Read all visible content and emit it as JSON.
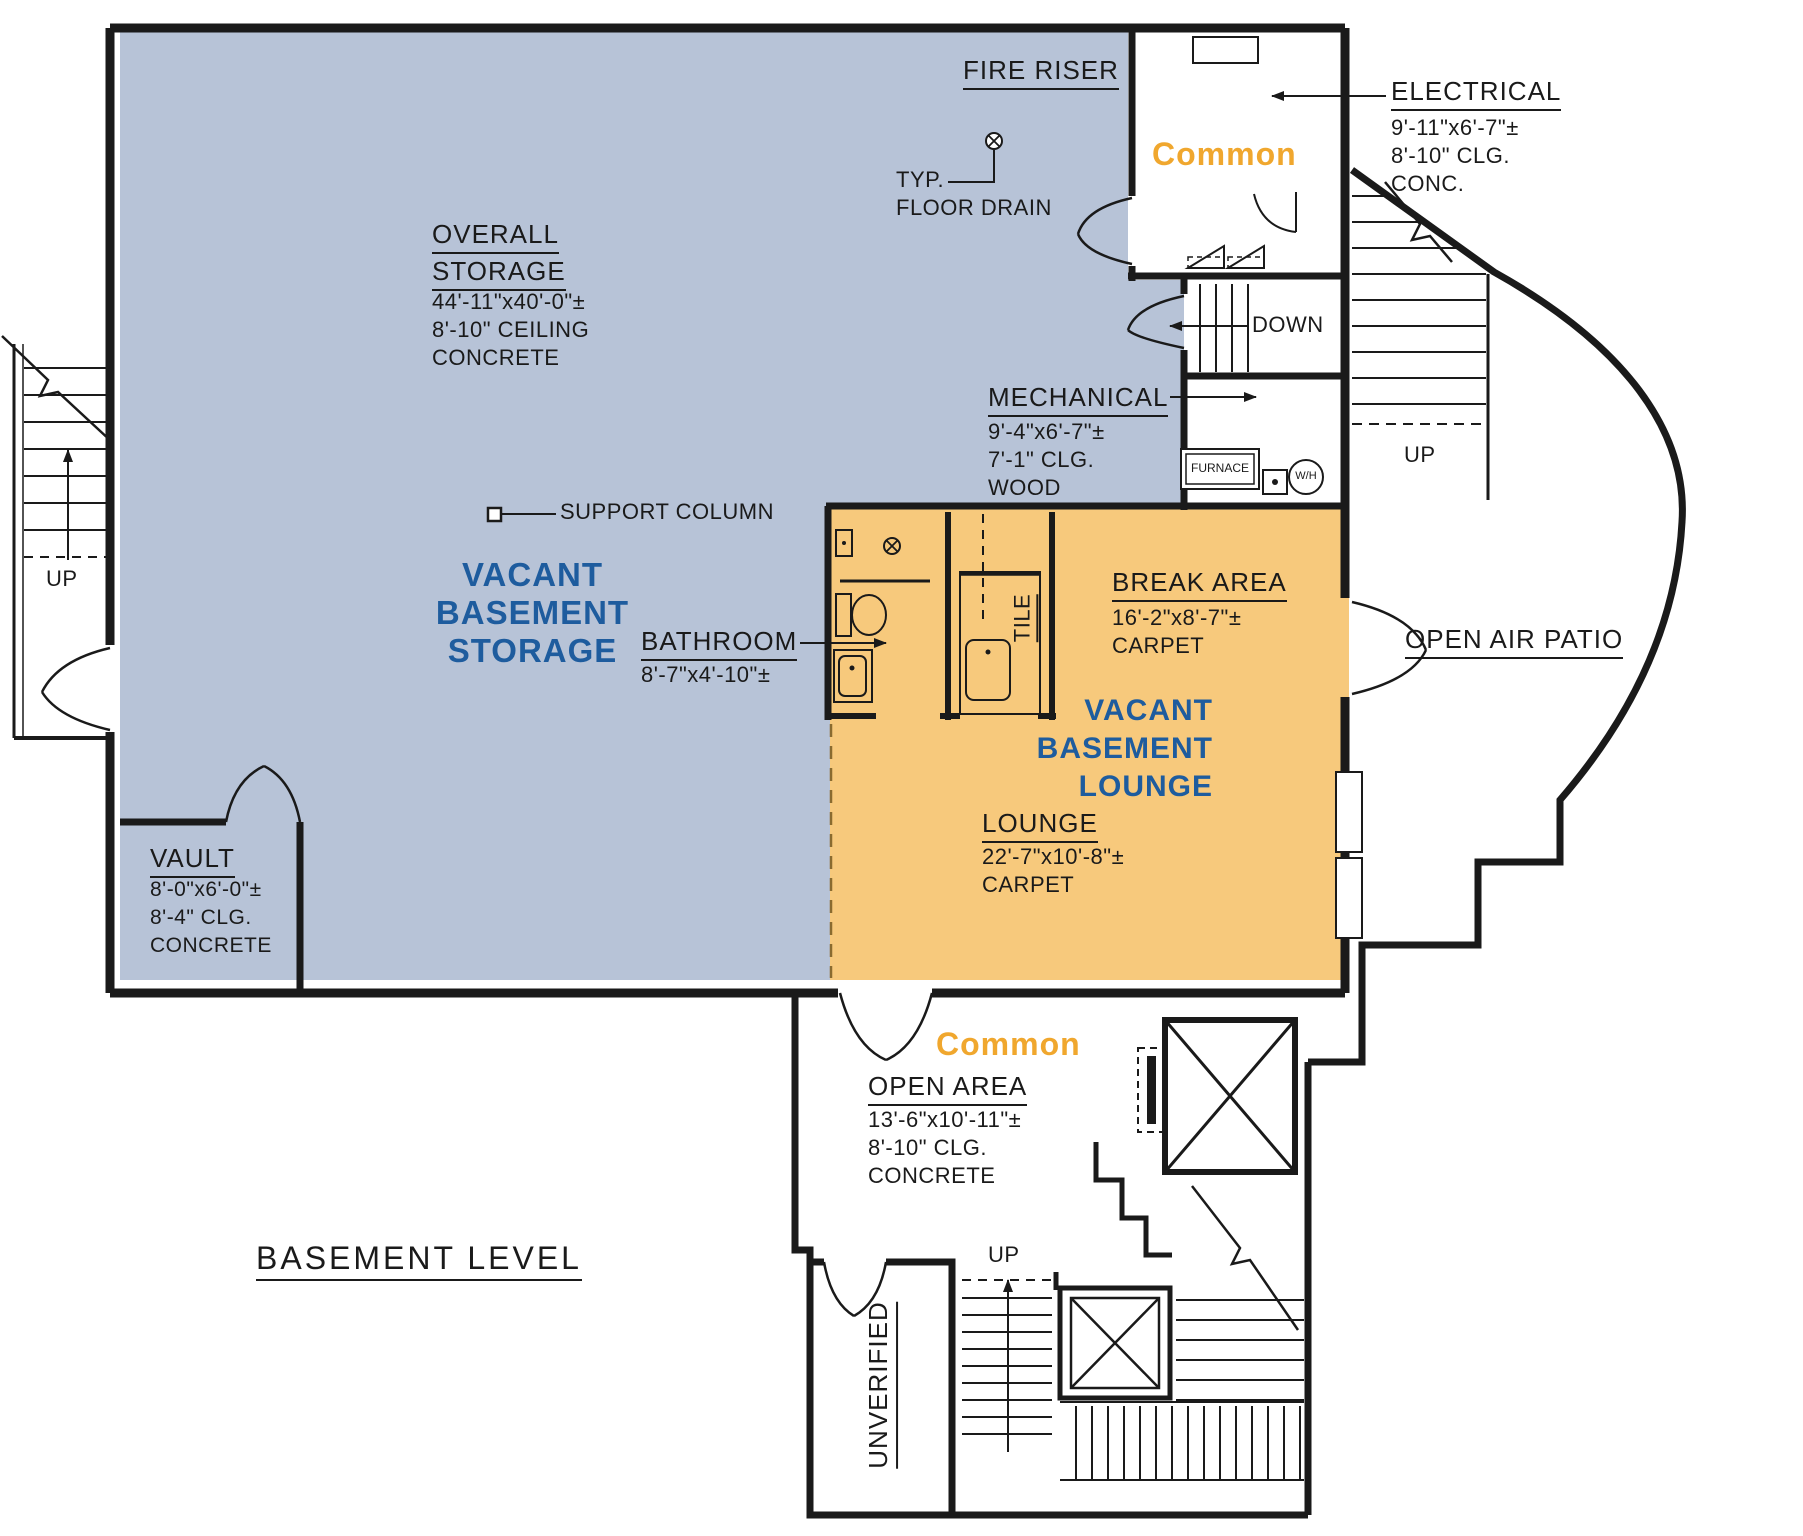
{
  "colors": {
    "storage_fill": "#b7c3d7",
    "lounge_fill": "#f7c97c",
    "zone_text_blue": "#1e5c9e",
    "common_text_orange": "#f0a72e",
    "line": "#1a1a1a"
  },
  "plan_title": "BASEMENT LEVEL",
  "fire_riser": {
    "label": "FIRE RISER"
  },
  "floor_drain_note": {
    "line1": "TYP.",
    "line2": "FLOOR DRAIN"
  },
  "overall_storage": {
    "label_line1": "OVERALL",
    "label_line2": "STORAGE",
    "dim": "44'-11\"x40'-0\"±",
    "ceiling": "8'-10\" CEILING",
    "finish": "CONCRETE"
  },
  "storage_zone": {
    "line1": "VACANT",
    "line2": "BASEMENT",
    "line3": "STORAGE"
  },
  "support_column": {
    "label": "SUPPORT COLUMN"
  },
  "common_upper": {
    "label": "Common"
  },
  "electrical": {
    "label": "ELECTRICAL",
    "dim": "9'-11\"x6'-7\"±",
    "ceiling": "8'-10\" CLG.",
    "finish": "CONC."
  },
  "mechanical": {
    "label": "MECHANICAL",
    "dim": "9'-4\"x6'-7\"±",
    "ceiling": "7'-1\" CLG.",
    "finish": "WOOD"
  },
  "down_label": "DOWN",
  "furnace_label": "FURNACE",
  "water_heater_label": "W/H",
  "up_right": "UP",
  "up_left": "UP",
  "up_bottom": "UP",
  "bathroom": {
    "label": "BATHROOM",
    "dim": "8'-7\"x4'-10\"±"
  },
  "tile_label": "TILE",
  "break_area": {
    "label": "BREAK AREA",
    "dim": "16'-2\"x8'-7\"±",
    "finish": "CARPET"
  },
  "lounge_zone": {
    "line1": "VACANT",
    "line2": "BASEMENT",
    "line3": "LOUNGE"
  },
  "lounge": {
    "label": "LOUNGE",
    "dim": "22'-7\"x10'-8\"±",
    "finish": "CARPET"
  },
  "patio": {
    "label": "OPEN AIR PATIO"
  },
  "vault": {
    "label": "VAULT",
    "dim": "8'-0\"x6'-0\"±",
    "ceiling": "8'-4\" CLG.",
    "finish": "CONCRETE"
  },
  "common_lower": {
    "label": "Common"
  },
  "open_area": {
    "label": "OPEN AREA",
    "dim": "13'-6\"x10'-11\"±",
    "ceiling": "8'-10\" CLG.",
    "finish": "CONCRETE"
  },
  "unverified_label": "UNVERIFIED"
}
